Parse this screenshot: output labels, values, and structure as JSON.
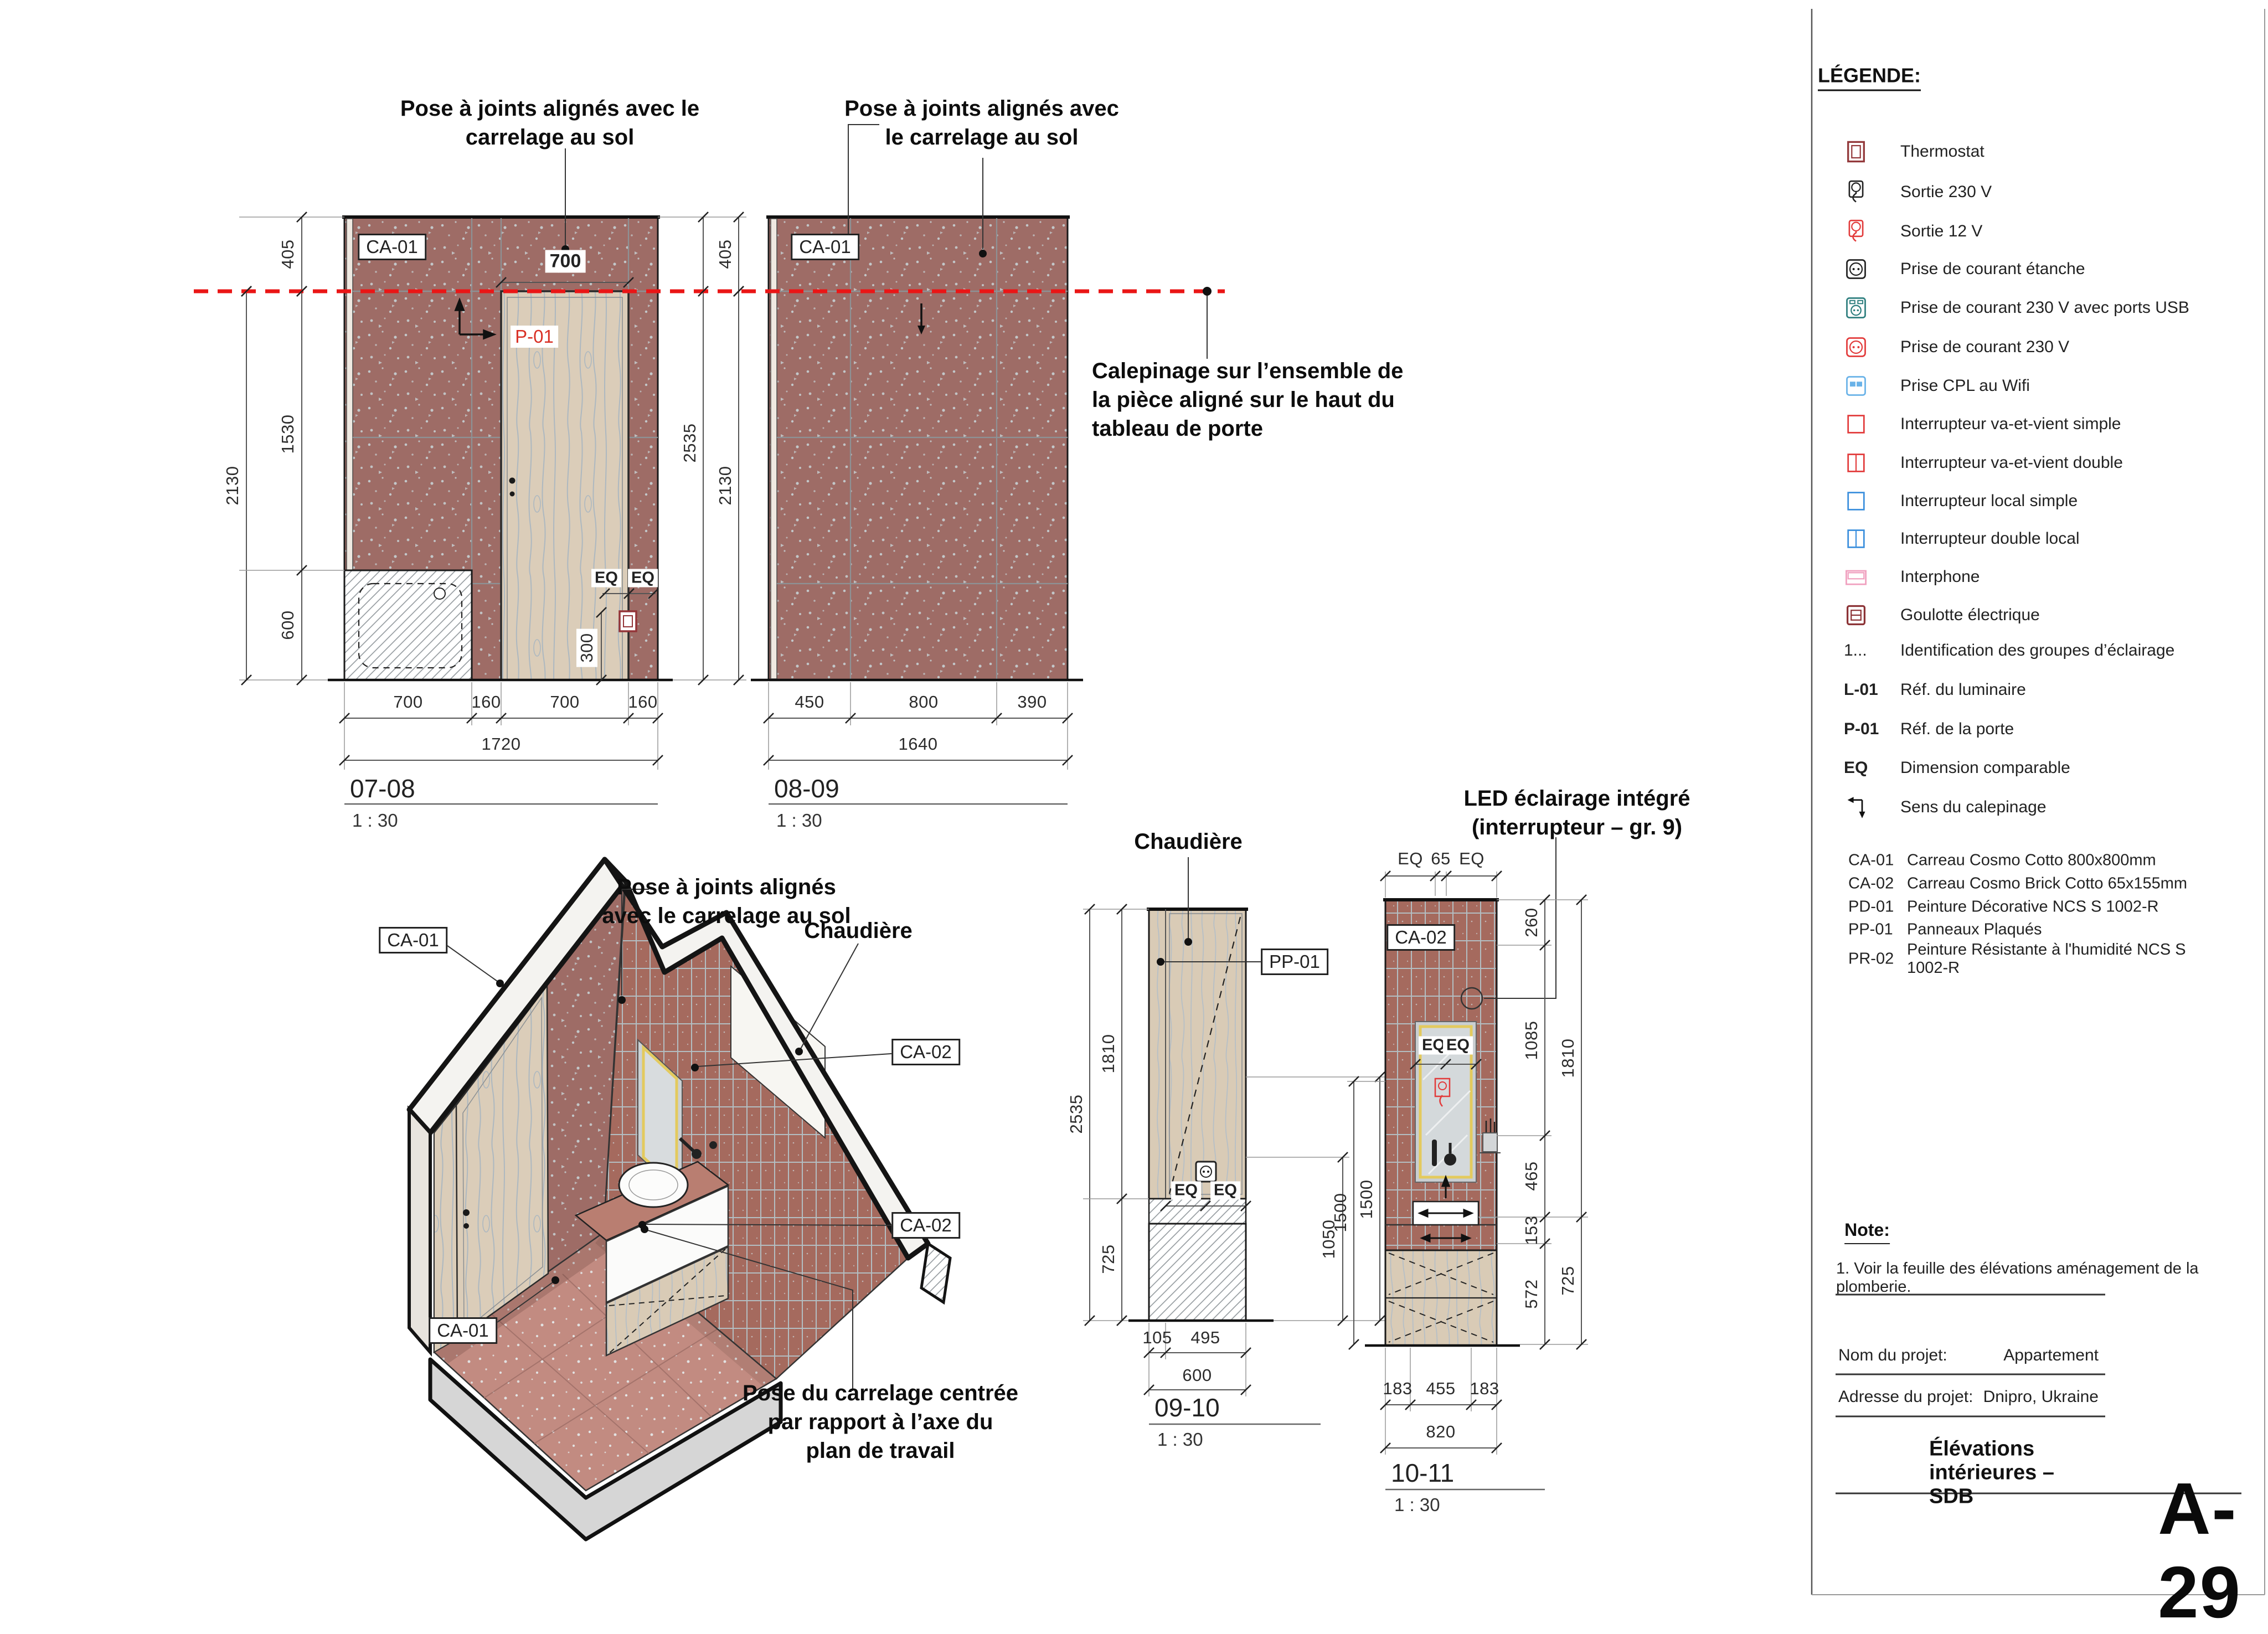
{
  "sheet": {
    "number": "A-29",
    "title": "Élévations intérieures – SDB"
  },
  "legend": {
    "title": "LÉGENDE:",
    "items": [
      {
        "icon": "thermostat-icon",
        "label": "Thermostat"
      },
      {
        "icon": "outlet-230v-icon",
        "label": "Sortie 230 V"
      },
      {
        "icon": "outlet-12v-icon",
        "label": "Sortie 12 V"
      },
      {
        "icon": "socket-waterproof-icon",
        "label": "Prise de courant étanche"
      },
      {
        "icon": "socket-usb-icon",
        "label": "Prise de courant 230 V avec ports USB"
      },
      {
        "icon": "socket-230v-icon",
        "label": "Prise de courant 230 V"
      },
      {
        "icon": "cpl-wifi-icon",
        "label": "Prise CPL au Wifi"
      },
      {
        "icon": "switch-2way-single-icon",
        "label": "Interrupteur va-et-vient simple"
      },
      {
        "icon": "switch-2way-double-icon",
        "label": "Interrupteur va-et-vient double"
      },
      {
        "icon": "switch-local-single-icon",
        "label": "Interrupteur local simple"
      },
      {
        "icon": "switch-local-double-icon",
        "label": "Interrupteur double local"
      },
      {
        "icon": "intercom-icon",
        "label": "Interphone"
      },
      {
        "icon": "duct-icon",
        "label": "Goulotte électrique"
      }
    ],
    "refs": [
      {
        "code": "1...",
        "label": "Identification des groupes d’éclairage",
        "red": true
      },
      {
        "code": "L-01",
        "label": "Réf. du luminaire",
        "bold": true
      },
      {
        "code": "P-01",
        "label": "Réf. de la porte",
        "bold": true
      },
      {
        "code": "EQ",
        "label": "Dimension comparable",
        "bold": true
      },
      {
        "code": "",
        "icon": "layout-direction-icon",
        "label": "Sens du calepinage"
      }
    ],
    "materials": [
      {
        "code": "CA-01",
        "label": "Carreau Cosmo Cotto 800x800mm"
      },
      {
        "code": "CA-02",
        "label": "Carreau Cosmo Brick Cotto 65x155mm"
      },
      {
        "code": "PD-01",
        "label": "Peinture Décorative NCS S 1002-R"
      },
      {
        "code": "PP-01",
        "label": "Panneaux Plaqués"
      },
      {
        "code": "PR-02",
        "label": "Peinture Résistante à l'humidité NCS S 1002-R"
      }
    ]
  },
  "note": {
    "title": "Note:",
    "body": "1. Voir la feuille des élévations aménagement de la plomberie."
  },
  "project": {
    "name_label": "Nom du projet:",
    "name": "Appartement",
    "address_label": "Adresse du projet:",
    "address": "Dnipro, Ukraine"
  },
  "annotations": {
    "pose_0708_l1": "Pose à joints alignés avec le",
    "pose_0708_l2": "carrelage au sol",
    "pose_0809_l1": "Pose à joints alignés avec",
    "pose_0809_l2": "le carrelage au sol",
    "calepinage_l1": "Calepinage sur l’ensemble de",
    "calepinage_l2": "la pièce aligné sur le haut du",
    "calepinage_l3": "tableau de porte",
    "pose_axon_l1": "Pose à joints alignés",
    "pose_axon_l2": "avec le carrelage au sol",
    "chaudiere": "Chaudière",
    "led_l1": "LED éclairage intégré",
    "led_l2": "(interrupteur – gr. 9)",
    "pose_centree_l1": "Pose du carrelage centrée",
    "pose_centree_l2": "par rapport à l’axe du",
    "pose_centree_l3": "plan de travail"
  },
  "tags": {
    "ca01": "CA-01",
    "ca02": "CA-02",
    "p01": "P-01",
    "pp01": "PP-01",
    "eq": "EQ",
    "d700": "700",
    "d300": "300"
  },
  "elevations": {
    "e0708": {
      "title": "07-08",
      "scale": "1 : 30",
      "left": [
        "405",
        "1530",
        "600"
      ],
      "left_total": "2130",
      "right": [
        "405",
        "2130"
      ],
      "right_total": "2535",
      "bottom": [
        "700",
        "160",
        "700",
        "160"
      ],
      "bottom_total": "1720"
    },
    "e0809": {
      "title": "08-09",
      "scale": "1 : 30",
      "bottom": [
        "450",
        "800",
        "390"
      ],
      "bottom_total": "1640"
    },
    "e0910": {
      "title": "09-10",
      "scale": "1 : 30",
      "left": [
        "1810",
        "725"
      ],
      "left_total": "2535",
      "right": [
        "1050",
        "1500"
      ],
      "bottom": [
        "105",
        "495"
      ],
      "bottom_total": "600"
    },
    "e1011": {
      "title": "10-11",
      "scale": "1 : 30",
      "top": [
        "EQ",
        "65",
        "EQ"
      ],
      "right": [
        "260",
        "1085",
        "465",
        "153",
        "572"
      ],
      "right2": [
        "1810",
        "725"
      ],
      "left": "1500",
      "bottom": [
        "183",
        "455",
        "183"
      ],
      "bottom_total": "820"
    }
  }
}
